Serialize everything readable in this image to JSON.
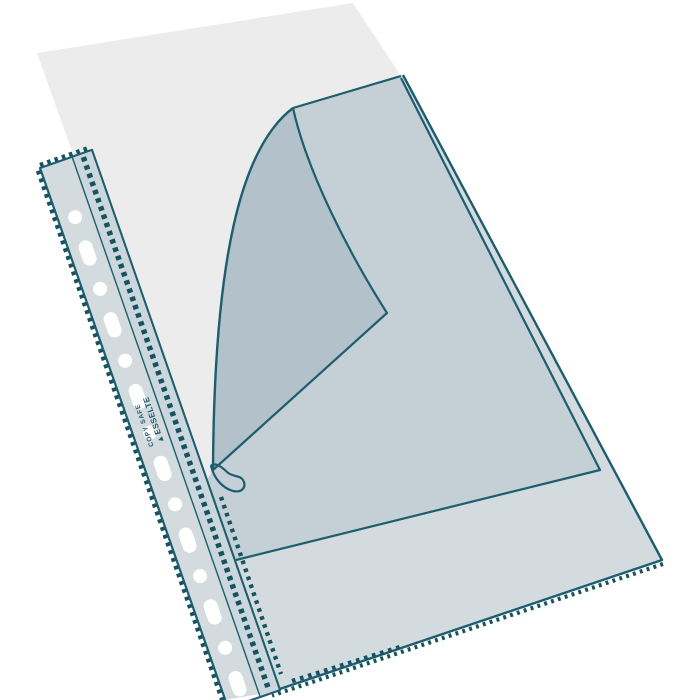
{
  "description": "Product illustration of a transparent A4 punched pocket (sheet protector) with multipunched filing strip, an inserted paper sheet, and the front film corner folded back with a curled tip",
  "strip_text": {
    "line1": "COPY SAFE",
    "logo_glyph": "▲",
    "line2": "ESSELTE"
  },
  "colors": {
    "background": "#ffffff",
    "outline_teal": "#1e5d6e",
    "perforation_teal": "#165360",
    "paper": "#ececec",
    "pocket_over_white": "#d3dbdf",
    "pocket_over_paper": "#c5cfd6",
    "flap_crescent": "#b3c1ca",
    "strip_punch_band": "#d9e1e5",
    "strip_square_band": "#cbd7dd",
    "curl_tab": "#e7ebee",
    "punch_hole": "#ffffff"
  }
}
